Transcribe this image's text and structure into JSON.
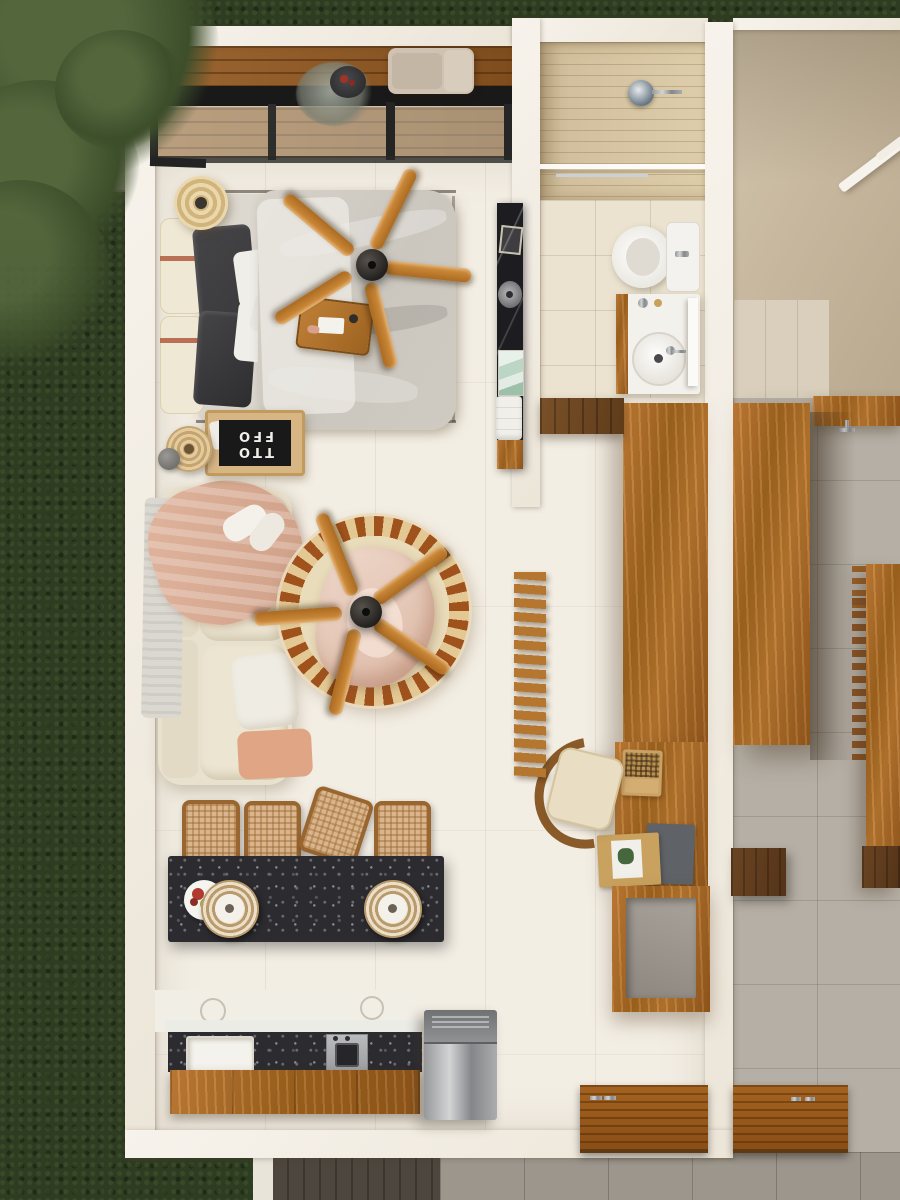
{
  "scene": {
    "description": "Top-down 3D render of a furnished studio apartment (unit A) beside a mirrored, mostly empty adjacent unit (unit B), surrounded by dark lawn with a tree canopy at top-left",
    "view": "top-down"
  },
  "palette": {
    "grass": "#2e3c22",
    "walkway": "#8d877c",
    "wallWhite": "#f7f3ec",
    "floorCream": "#f3eee4",
    "deckWood": "#7f4d1d",
    "wood": "#b06c26",
    "walnut": "#6b4523",
    "marbleBlack": "#1d1d21",
    "terrazzoBlack": "#2c2c30",
    "fanBlade": "#aa6a21",
    "fanHub": "#22201e",
    "rugBorder": "#a0521d",
    "sofaCream": "#e8e1cd",
    "blanketPink": "#dcb09a",
    "pillowDark": "#3a393c",
    "duvetGrey": "#cbc7bf",
    "bathFloor": "#ebe2cf",
    "showerWood": "#decdaa",
    "nbWall": "#cbbca4",
    "nbFloor": "#b6afa5",
    "greyTile": "#9d968c",
    "steel": "#aaacae",
    "rattan": "#d9b48c",
    "frameBlack": "#191919"
  },
  "unit_a": {
    "balcony": {
      "items": [
        "wood-deck",
        "lounge-armchair",
        "planter-with-red-flowers",
        "black-framed-glass-sliding-door",
        "white-parapet"
      ]
    },
    "bedroom": {
      "items": [
        "double-bed",
        "grey-duvet",
        "dark-pillows",
        "white-pillows",
        "headboard-cushions-with-rust-straps",
        "breakfast-tray",
        "five-blade-ceiling-fan",
        "rattan-pendant-lamp",
        "bedside-table",
        "rattan-stool",
        "decor-sphere"
      ],
      "poster_lines": [
        "TTO",
        "FFO"
      ]
    },
    "bathroom": {
      "items": [
        "walk-in-shower",
        "rain-shower-head",
        "glass-partition",
        "toilet",
        "vanity-with-round-basin",
        "mirror-shelf"
      ]
    },
    "hall": {
      "items": [
        "black-marble-console",
        "vessel-basin",
        "folded-towels",
        "artwork",
        "shoe-bench",
        "wardrobe-loft",
        "open-slat-stair"
      ]
    },
    "living": {
      "items": [
        "cream-sofa",
        "pink-throw-blanket",
        "fringed-throw",
        "round-ornamental-rug",
        "five-blade-ceiling-fan",
        "pouf-with-blanket"
      ]
    },
    "dining": {
      "stool_count": 4,
      "items": [
        "terrazzo-bar-table",
        "rattan-stools",
        "woven-charger-plates",
        "fruit-plate"
      ]
    },
    "kitchen": {
      "items": [
        "terrazzo-counter",
        "inset-sink",
        "gas-hob",
        "timber-cabinets",
        "stainless-refrigerator"
      ]
    },
    "study": {
      "items": [
        "timber-desk",
        "laptop",
        "books",
        "cane-chair",
        "open-cube-shelf"
      ]
    },
    "entry": {
      "items": [
        "timber-entry-mat",
        "steel-handles"
      ]
    }
  },
  "unit_b": {
    "items": [
      "empty-beige-room",
      "white-railing",
      "timber-counter",
      "stair-slats",
      "timber-loft-panel",
      "walnut-cabinets",
      "timber-entry-mat"
    ]
  },
  "exterior": {
    "items": [
      "lawn",
      "tree-canopy",
      "stone-walkway",
      "timber-boardwalk",
      "white-path-strip",
      "grey-pavers"
    ]
  }
}
